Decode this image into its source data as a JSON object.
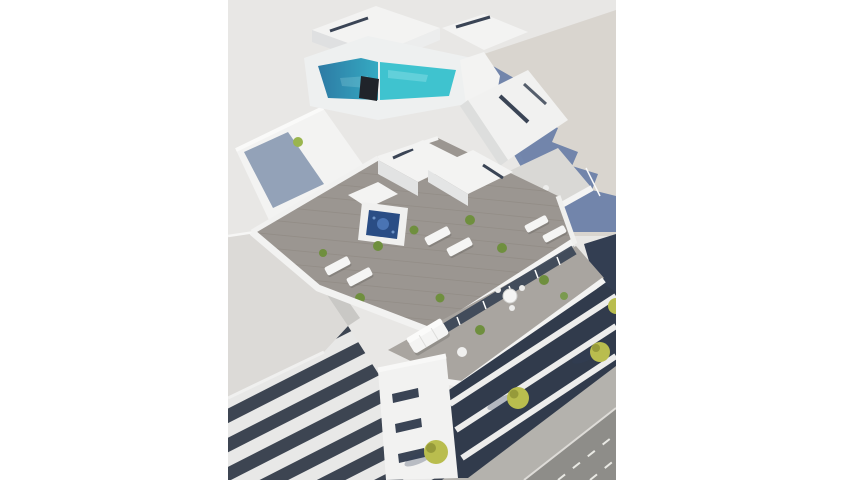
{
  "image": {
    "kind": "architectural-3d-render",
    "description": "Aerial 3D rendering of a modern white apartment building with a turquoise rooftop pool, jacuzzi, furnished roof terraces and balconies, beside a tree-lined street",
    "alt": "New-build apartment block seen from above with rooftop pool and terraces"
  },
  "scene": {
    "objects": [
      "ground-plane",
      "building-shadow",
      "neighbor-building-roof",
      "neighbor-facade",
      "penthouse-roof",
      "rooftop-pool",
      "pool-deck",
      "hot-tub",
      "sun-loungers",
      "roof-terrace",
      "dining-set",
      "potted-plants",
      "outdoor-sofa",
      "glass-doors",
      "stair-tower",
      "balcony-facade",
      "sidewalk",
      "street",
      "lane-markings",
      "street-trees"
    ]
  },
  "colors": {
    "page_bg": "#ffffff",
    "photo_bg": "#e8e7e5",
    "ground": "#d9d5cf",
    "shadow": "#667ca6",
    "building_white": "#f3f3f2",
    "building_shade": "#dfe0e1",
    "deck": "#9b9691",
    "deck_light": "#a9a5a0",
    "pool_deep": "#2d7aa4",
    "pool_shallow": "#3fc3cf",
    "pool_sparkle": "#8fe0e6",
    "hot_tub": "#2a4d85",
    "hot_tub_water": "#4a74b4",
    "glass_dark": "#3a4455",
    "facade_dark": "#313b4c",
    "stripe_dark": "#3d4552",
    "stripe_light": "#e8e8e7",
    "street": "#8e8d89",
    "sidewalk": "#b4b2ad",
    "road_marking": "#e9e9e4",
    "tree": "#b9bd4e",
    "tree_dark": "#969a3a",
    "shrub": "#6f8f3e",
    "neighbor_roof": "#dcdad7",
    "shade_deck": "#93a2b8",
    "dark_cube": "#20242a",
    "navy_wedge": "#333e52"
  }
}
